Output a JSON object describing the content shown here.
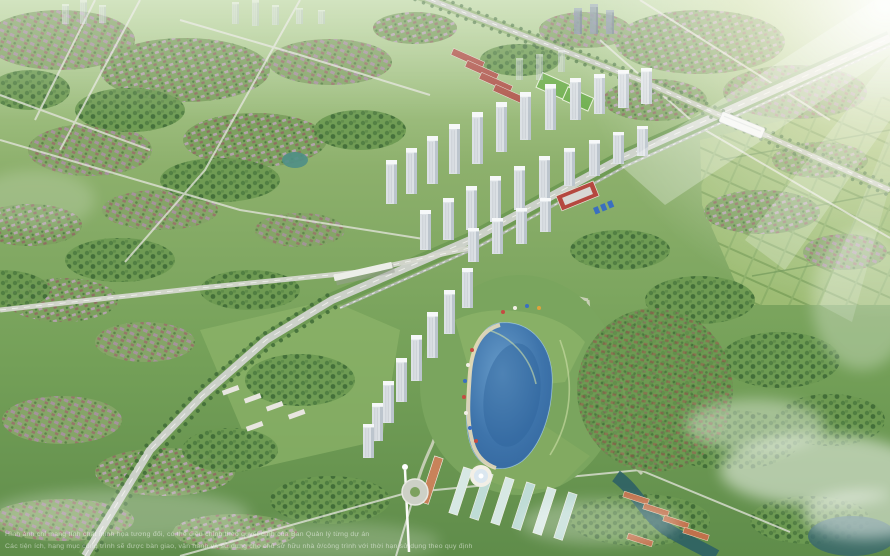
{
  "scene": {
    "kind": "aerial-masterplan-render",
    "watermark": {
      "line1": "Hình ảnh chỉ mang tính chất minh họa tương đối, có thể điều chỉnh theo quyết định của Ban Quản lý từng dự án",
      "line2": "Các tiện ích, hạng mục công trình sẽ được bàn giao, vận hành và sử dụng cho chủ sở hữu nhà ở/công trình với thời hạn sử dụng theo quy định"
    }
  },
  "colors": {
    "lake": "#3e74ab",
    "canal": "#2e6065",
    "highway": "#ccd1c9",
    "grass": "#7da15f",
    "tower_face": "#dce1e5",
    "flare": "#ffffff"
  }
}
